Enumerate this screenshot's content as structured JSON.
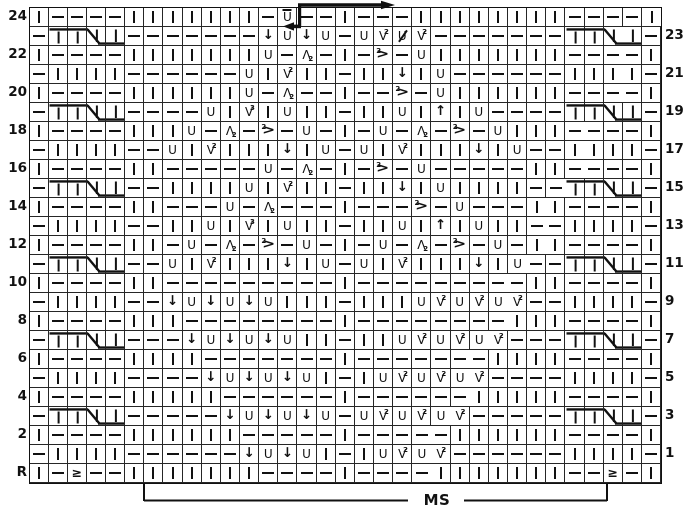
{
  "chart": {
    "type": "knitting-chart",
    "columns": 33,
    "ms_label": "MS",
    "symbols": {
      "k": "knit (vertical bar)",
      "p": "purl (dash)",
      "yo": "U yarn over",
      "you": "U with bar above (twisted yarn over)",
      "sl": "bold down arrow (slip/elongated stitch)",
      "up": "bold up arrow (centered double decrease)",
      "v2": "V with small 2 (increase 2)",
      "v3": "V with small 3 (increase 3)",
      "a2": "lambda with small 2 (left-leaning decrease)",
      "r2": "greater-than with small 2 (right-leaning decrease)",
      "us": "U with diagonal slash",
      "ssp": "greater-or-equal sign (edge decrease)",
      "c1": "cable 2/2 cell 1",
      "c2": "cable 2/2 cell 2",
      "c3": "cable 2/2 cell 3",
      "c4": "cable 2/2 cell 4"
    },
    "rows": [
      {
        "left": "24",
        "right": "",
        "cells": [
          "k",
          "p",
          "p",
          "p",
          "p",
          "k",
          "k",
          "k",
          "k",
          "k",
          "k",
          "k",
          "p",
          "you",
          "p",
          "p",
          "k",
          "p",
          "p",
          "p",
          "k",
          "k",
          "k",
          "k",
          "k",
          "k",
          "k",
          "k",
          "p",
          "p",
          "p",
          "p",
          "k"
        ]
      },
      {
        "left": "",
        "right": "23",
        "cells": [
          "p",
          "c1",
          "c2",
          "c3",
          "c4",
          "p",
          "p",
          "p",
          "p",
          "p",
          "p",
          "p",
          "sl",
          "yo",
          "sl",
          "yo",
          "p",
          "yo",
          "v2",
          "us",
          "v2",
          "p",
          "p",
          "p",
          "p",
          "p",
          "p",
          "p",
          "c1",
          "c2",
          "c3",
          "c4",
          "p"
        ]
      },
      {
        "left": "22",
        "right": "",
        "cells": [
          "k",
          "p",
          "p",
          "p",
          "p",
          "k",
          "k",
          "k",
          "k",
          "k",
          "k",
          "k",
          "yo",
          "p",
          "a2",
          "p",
          "k",
          "p",
          "r2",
          "p",
          "yo",
          "k",
          "k",
          "k",
          "k",
          "k",
          "k",
          "k",
          "p",
          "p",
          "p",
          "p",
          "k"
        ]
      },
      {
        "left": "",
        "right": "21",
        "cells": [
          "p",
          "k",
          "k",
          "k",
          "k",
          "p",
          "p",
          "p",
          "p",
          "p",
          "p",
          "yo",
          "k",
          "v2",
          "k",
          "k",
          "p",
          "k",
          "k",
          "sl",
          "k",
          "yo",
          "p",
          "p",
          "p",
          "p",
          "p",
          "p",
          "k",
          "k",
          "k",
          "k",
          "p"
        ]
      },
      {
        "left": "20",
        "right": "",
        "cells": [
          "k",
          "p",
          "p",
          "p",
          "p",
          "k",
          "k",
          "k",
          "k",
          "k",
          "k",
          "yo",
          "p",
          "a2",
          "p",
          "p",
          "k",
          "p",
          "p",
          "r2",
          "p",
          "yo",
          "k",
          "k",
          "k",
          "k",
          "k",
          "k",
          "p",
          "p",
          "p",
          "p",
          "k"
        ]
      },
      {
        "left": "",
        "right": "19",
        "cells": [
          "p",
          "c1",
          "c2",
          "c3",
          "c4",
          "p",
          "p",
          "p",
          "p",
          "yo",
          "k",
          "v3",
          "k",
          "yo",
          "k",
          "k",
          "p",
          "k",
          "k",
          "yo",
          "k",
          "up",
          "k",
          "yo",
          "p",
          "p",
          "p",
          "p",
          "c1",
          "c2",
          "c3",
          "c4",
          "p"
        ]
      },
      {
        "left": "18",
        "right": "",
        "cells": [
          "k",
          "p",
          "p",
          "p",
          "p",
          "k",
          "k",
          "k",
          "yo",
          "p",
          "a2",
          "p",
          "r2",
          "p",
          "yo",
          "p",
          "k",
          "p",
          "yo",
          "p",
          "a2",
          "p",
          "r2",
          "p",
          "yo",
          "k",
          "k",
          "k",
          "p",
          "p",
          "p",
          "p",
          "k"
        ]
      },
      {
        "left": "",
        "right": "17",
        "cells": [
          "p",
          "k",
          "k",
          "k",
          "k",
          "p",
          "p",
          "yo",
          "k",
          "v2",
          "k",
          "k",
          "k",
          "sl",
          "k",
          "yo",
          "p",
          "yo",
          "k",
          "v2",
          "k",
          "k",
          "k",
          "sl",
          "k",
          "yo",
          "p",
          "p",
          "k",
          "k",
          "k",
          "k",
          "p"
        ]
      },
      {
        "left": "16",
        "right": "",
        "cells": [
          "k",
          "p",
          "p",
          "p",
          "p",
          "k",
          "k",
          "p",
          "p",
          "p",
          "p",
          "p",
          "yo",
          "p",
          "a2",
          "p",
          "k",
          "p",
          "r2",
          "p",
          "yo",
          "p",
          "p",
          "p",
          "p",
          "p",
          "k",
          "k",
          "p",
          "p",
          "p",
          "p",
          "k"
        ]
      },
      {
        "left": "",
        "right": "15",
        "cells": [
          "p",
          "c1",
          "c2",
          "c3",
          "c4",
          "p",
          "p",
          "k",
          "k",
          "k",
          "k",
          "yo",
          "k",
          "v2",
          "k",
          "k",
          "p",
          "k",
          "k",
          "sl",
          "k",
          "yo",
          "k",
          "k",
          "k",
          "k",
          "p",
          "p",
          "c1",
          "c2",
          "c3",
          "c4",
          "p"
        ]
      },
      {
        "left": "14",
        "right": "",
        "cells": [
          "k",
          "p",
          "p",
          "p",
          "p",
          "k",
          "k",
          "p",
          "p",
          "p",
          "yo",
          "p",
          "a2",
          "p",
          "p",
          "p",
          "k",
          "p",
          "p",
          "p",
          "r2",
          "p",
          "yo",
          "p",
          "p",
          "p",
          "k",
          "k",
          "p",
          "p",
          "p",
          "p",
          "k"
        ]
      },
      {
        "left": "",
        "right": "13",
        "cells": [
          "p",
          "k",
          "k",
          "k",
          "k",
          "p",
          "p",
          "k",
          "k",
          "yo",
          "k",
          "v3",
          "k",
          "yo",
          "k",
          "k",
          "p",
          "k",
          "k",
          "yo",
          "k",
          "up",
          "k",
          "yo",
          "k",
          "k",
          "p",
          "p",
          "k",
          "k",
          "k",
          "k",
          "p"
        ]
      },
      {
        "left": "12",
        "right": "",
        "cells": [
          "k",
          "p",
          "p",
          "p",
          "p",
          "k",
          "k",
          "p",
          "yo",
          "p",
          "a2",
          "p",
          "r2",
          "p",
          "yo",
          "p",
          "k",
          "p",
          "yo",
          "p",
          "a2",
          "p",
          "r2",
          "p",
          "yo",
          "p",
          "k",
          "k",
          "p",
          "p",
          "p",
          "p",
          "k"
        ]
      },
      {
        "left": "",
        "right": "11",
        "cells": [
          "p",
          "c1",
          "c2",
          "c3",
          "c4",
          "p",
          "p",
          "yo",
          "k",
          "v2",
          "k",
          "k",
          "k",
          "sl",
          "k",
          "yo",
          "p",
          "yo",
          "k",
          "v2",
          "k",
          "k",
          "k",
          "sl",
          "k",
          "yo",
          "p",
          "p",
          "c1",
          "c2",
          "c3",
          "c4",
          "p"
        ]
      },
      {
        "left": "10",
        "right": "",
        "cells": [
          "k",
          "p",
          "p",
          "p",
          "p",
          "k",
          "k",
          "p",
          "p",
          "p",
          "p",
          "p",
          "p",
          "p",
          "p",
          "p",
          "k",
          "p",
          "p",
          "p",
          "p",
          "p",
          "p",
          "p",
          "p",
          "p",
          "k",
          "k",
          "p",
          "p",
          "p",
          "p",
          "k"
        ]
      },
      {
        "left": "",
        "right": "9",
        "cells": [
          "p",
          "k",
          "k",
          "k",
          "k",
          "p",
          "p",
          "sl",
          "yo",
          "sl",
          "yo",
          "sl",
          "yo",
          "k",
          "k",
          "k",
          "p",
          "k",
          "k",
          "k",
          "yo",
          "v2",
          "yo",
          "v2",
          "yo",
          "v2",
          "p",
          "p",
          "k",
          "k",
          "k",
          "k",
          "p"
        ]
      },
      {
        "left": "8",
        "right": "",
        "cells": [
          "k",
          "p",
          "p",
          "p",
          "p",
          "k",
          "k",
          "k",
          "p",
          "p",
          "p",
          "p",
          "p",
          "p",
          "p",
          "p",
          "k",
          "p",
          "p",
          "p",
          "p",
          "p",
          "p",
          "p",
          "p",
          "k",
          "k",
          "k",
          "p",
          "p",
          "p",
          "p",
          "k"
        ]
      },
      {
        "left": "",
        "right": "7",
        "cells": [
          "p",
          "c1",
          "c2",
          "c3",
          "c4",
          "p",
          "p",
          "p",
          "sl",
          "yo",
          "sl",
          "yo",
          "sl",
          "yo",
          "k",
          "k",
          "p",
          "k",
          "k",
          "yo",
          "v2",
          "yo",
          "v2",
          "yo",
          "v2",
          "p",
          "p",
          "p",
          "c1",
          "c2",
          "c3",
          "c4",
          "p"
        ]
      },
      {
        "left": "6",
        "right": "",
        "cells": [
          "k",
          "p",
          "p",
          "p",
          "p",
          "k",
          "k",
          "k",
          "k",
          "p",
          "p",
          "p",
          "p",
          "p",
          "p",
          "p",
          "k",
          "p",
          "p",
          "p",
          "p",
          "p",
          "p",
          "p",
          "k",
          "k",
          "k",
          "k",
          "p",
          "p",
          "p",
          "p",
          "k"
        ]
      },
      {
        "left": "",
        "right": "5",
        "cells": [
          "p",
          "k",
          "k",
          "k",
          "k",
          "p",
          "p",
          "p",
          "p",
          "sl",
          "yo",
          "sl",
          "yo",
          "sl",
          "yo",
          "k",
          "p",
          "k",
          "yo",
          "v2",
          "yo",
          "v2",
          "yo",
          "v2",
          "p",
          "p",
          "p",
          "p",
          "k",
          "k",
          "k",
          "k",
          "p"
        ]
      },
      {
        "left": "4",
        "right": "",
        "cells": [
          "k",
          "p",
          "p",
          "p",
          "p",
          "k",
          "k",
          "k",
          "k",
          "k",
          "p",
          "p",
          "p",
          "p",
          "p",
          "p",
          "k",
          "p",
          "p",
          "p",
          "p",
          "p",
          "p",
          "k",
          "k",
          "k",
          "k",
          "k",
          "p",
          "p",
          "p",
          "p",
          "k"
        ]
      },
      {
        "left": "",
        "right": "3",
        "cells": [
          "p",
          "c1",
          "c2",
          "c3",
          "c4",
          "p",
          "p",
          "p",
          "p",
          "p",
          "sl",
          "yo",
          "sl",
          "yo",
          "sl",
          "yo",
          "p",
          "yo",
          "v2",
          "yo",
          "v2",
          "yo",
          "v2",
          "p",
          "p",
          "p",
          "p",
          "p",
          "c1",
          "c2",
          "c3",
          "c4",
          "p"
        ]
      },
      {
        "left": "2",
        "right": "",
        "cells": [
          "k",
          "p",
          "p",
          "p",
          "p",
          "k",
          "k",
          "k",
          "k",
          "k",
          "k",
          "p",
          "p",
          "p",
          "p",
          "p",
          "k",
          "p",
          "p",
          "p",
          "p",
          "p",
          "k",
          "k",
          "k",
          "k",
          "k",
          "k",
          "p",
          "p",
          "p",
          "p",
          "k"
        ]
      },
      {
        "left": "",
        "right": "1",
        "cells": [
          "p",
          "k",
          "k",
          "k",
          "k",
          "p",
          "p",
          "p",
          "p",
          "p",
          "p",
          "sl",
          "yo",
          "sl",
          "yo",
          "k",
          "p",
          "k",
          "yo",
          "v2",
          "yo",
          "v2",
          "p",
          "p",
          "p",
          "p",
          "p",
          "p",
          "k",
          "k",
          "k",
          "k",
          "p"
        ]
      },
      {
        "left": "R",
        "right": "",
        "cells": [
          "k",
          "p",
          "ssp",
          "p",
          "p",
          "k",
          "k",
          "k",
          "k",
          "k",
          "k",
          "k",
          "p",
          "p",
          "p",
          "p",
          "k",
          "p",
          "p",
          "p",
          "p",
          "k",
          "k",
          "k",
          "k",
          "k",
          "k",
          "k",
          "p",
          "p",
          "ssp",
          "p",
          "k"
        ]
      }
    ]
  }
}
